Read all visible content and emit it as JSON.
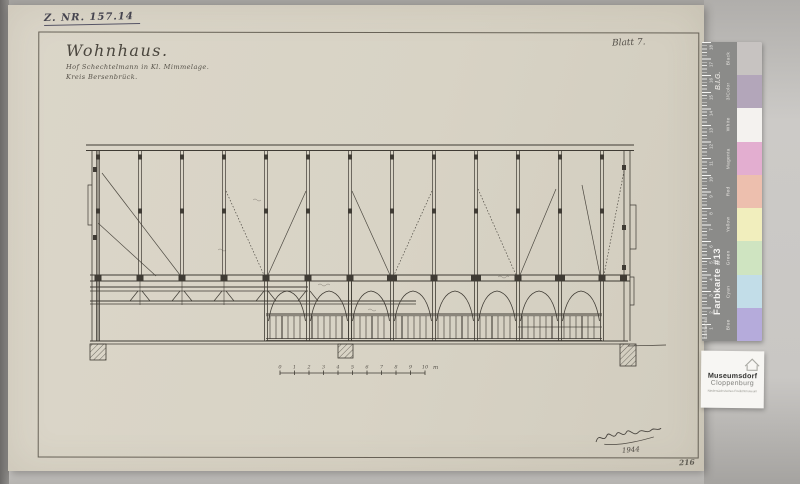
{
  "archive_note": "Z. NR. 157.14",
  "sheet_label": "Blatt 7.",
  "title_block": {
    "title": "Wohnhaus.",
    "subtitle_line1": "Hof Schechtelmann in Kl. Mimmelage.",
    "subtitle_line2": "Kreis Bersenbrück."
  },
  "signature": {
    "year": "1944"
  },
  "page_number": "216",
  "scale_bar": {
    "ticks": [
      "0",
      "1",
      "2",
      "3",
      "4",
      "5",
      "6",
      "7",
      "8",
      "9",
      "10"
    ],
    "unit": "m"
  },
  "color_card": {
    "brand": "B.I.G.",
    "card_label": "Farbkarte #13",
    "comment_label": "Kommentar",
    "background": "#8b8b89",
    "ruler_numbers": [
      "18",
      "17",
      "16",
      "15",
      "14",
      "13",
      "12",
      "11",
      "10",
      "9",
      "8",
      "7",
      "6",
      "5",
      "4",
      "3",
      "2",
      "1"
    ],
    "patches": [
      {
        "label": "Black",
        "color": "#c7c3c1"
      },
      {
        "label": "3/Color",
        "color": "#b3a6ba"
      },
      {
        "label": "White",
        "color": "#f4f2ef"
      },
      {
        "label": "Magenta",
        "color": "#e3aed0"
      },
      {
        "label": "Red",
        "color": "#edbfae"
      },
      {
        "label": "Yellow",
        "color": "#f1eebd"
      },
      {
        "label": "Green",
        "color": "#cfe4c1"
      },
      {
        "label": "Cyan",
        "color": "#c2dde8"
      },
      {
        "label": "Blue",
        "color": "#b5abdb"
      }
    ]
  },
  "museum_label": {
    "line1": "Museumsdorf",
    "line2": "Cloppenburg",
    "line3": "Niedersächsisches Freilichtmuseum"
  },
  "colors": {
    "paper": "#d8d3c5",
    "ink": "#3f3b34",
    "scan_background": "#c6c4c1"
  }
}
